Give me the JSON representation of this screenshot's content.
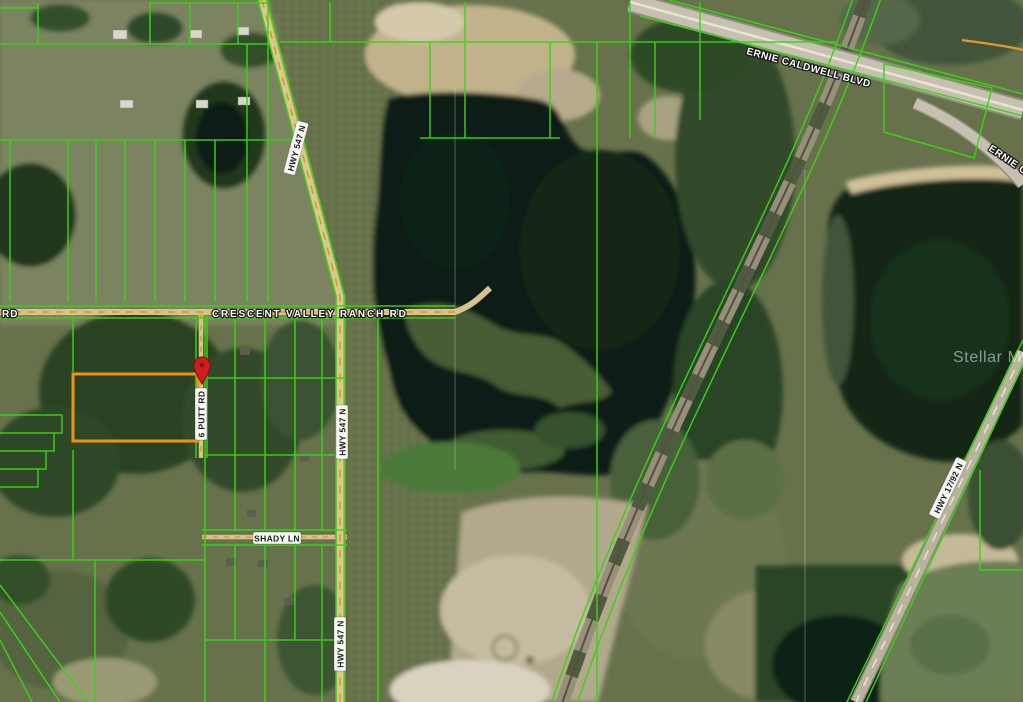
{
  "map": {
    "watermark_text": "Stellar MLS",
    "colors": {
      "parcel_line": "#3bd316",
      "highlight_parcel": "#ef9117",
      "marker": "#cf1d1d",
      "road_dash": "#df8f2e"
    },
    "marker_icon": "location-pin-icon",
    "road_labels": [
      {
        "id": "ernie-caldwell-blvd",
        "text": "ERNIE CALDWELL BLVD"
      },
      {
        "id": "ernie-caldwell-blvd-east",
        "text": "ERNIE CALDWELL BLVD"
      },
      {
        "id": "crescent-valley-ranch-rd",
        "text": "CRESCENT VALLEY RANCH RD"
      },
      {
        "id": "rd-partial-west",
        "text": "RD"
      },
      {
        "id": "hwy-547-n-upper",
        "text": "HWY 547 N"
      },
      {
        "id": "hwy-547-n-middle",
        "text": "HWY 547 N"
      },
      {
        "id": "hwy-547-n-lower",
        "text": "HWY 547 N"
      },
      {
        "id": "six-putt-rd",
        "text": "6 PUTT RD"
      },
      {
        "id": "shady-ln",
        "text": "SHADY LN"
      },
      {
        "id": "hwy-17-92-n",
        "text": "HWY 17/92 N"
      }
    ]
  }
}
